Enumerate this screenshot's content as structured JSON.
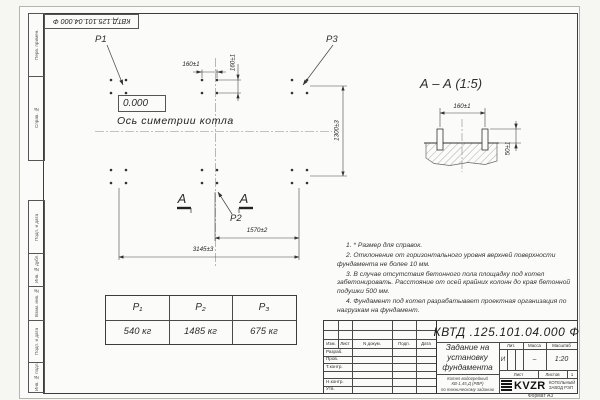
{
  "watermark": {
    "text": "kvzr.ru"
  },
  "margins": {
    "stamp": "КВТД.125.101.04.000  Ф",
    "top_strip": [
      "Перв. примен.",
      "Справ. №"
    ],
    "bottom_strip": [
      "Подп. и дата",
      "Инв. № дубл.",
      "Взам. инв. №",
      "Подп. и дата",
      "Инв. № подл."
    ],
    "format_label": "Формат А3"
  },
  "plan": {
    "point_labels": {
      "p1": "P1",
      "p2": "P2",
      "p3": "P3"
    },
    "elevation": "0.000",
    "axis_label": "Ось симетрии котла",
    "section_letter": "А",
    "dim_160_h": "160±1",
    "dim_160_v": "160±1",
    "dim_1300": "1300±3",
    "dim_1570": "1570±2",
    "dim_3145": "3145±3"
  },
  "section_view": {
    "title": "А  –  А (1:5)",
    "dim_160": "160±1",
    "dim_50": "50±1"
  },
  "notes": [
    "1. * Размер для справок.",
    "2. Отклонение от горизонтального уровня верхней поверхности фундамента не более 10 мм.",
    "3. В случае отсутствия бетонного пола площадку под котел забетонировать. Расстояние от осей крайних колонн до края бетонной подушки 500 мм.",
    "4. Фундамент под котел разрабатывает проектная организация по нагрузкам на фундамент."
  ],
  "load_table": {
    "headers": [
      "P₁",
      "P₂",
      "P₃"
    ],
    "values": [
      "540 кг",
      "1485 кг",
      "675 кг"
    ]
  },
  "title_block": {
    "doc_number": "КВТД .125.101.04.000   Ф",
    "title_lines": [
      "Задание на",
      "установку",
      "фундамента"
    ],
    "product_lines": [
      "Котел водогрейный",
      "КВ-1,45 Д (РВР)",
      "по техническому заданию"
    ],
    "col_headers": [
      "Изм.",
      "Лист",
      "N докум.",
      "Подп.",
      "Дата"
    ],
    "row_labels": [
      "Разраб.",
      "Пров.",
      "Т.контр.",
      "Н.контр.",
      "Утв."
    ],
    "lit_header": "Лит.",
    "mass_header": "Масса",
    "scale_header": "Масштаб",
    "lit_value": "И",
    "mass_value": "–",
    "scale_value": "1:20",
    "sheet_label": "Лист",
    "sheets_label": "Листов",
    "sheets_value": "1",
    "logo_text": "KVZR",
    "company_lines": [
      "КОТЕЛЬНЫЙ",
      "ЗАВОД РЭП"
    ]
  }
}
